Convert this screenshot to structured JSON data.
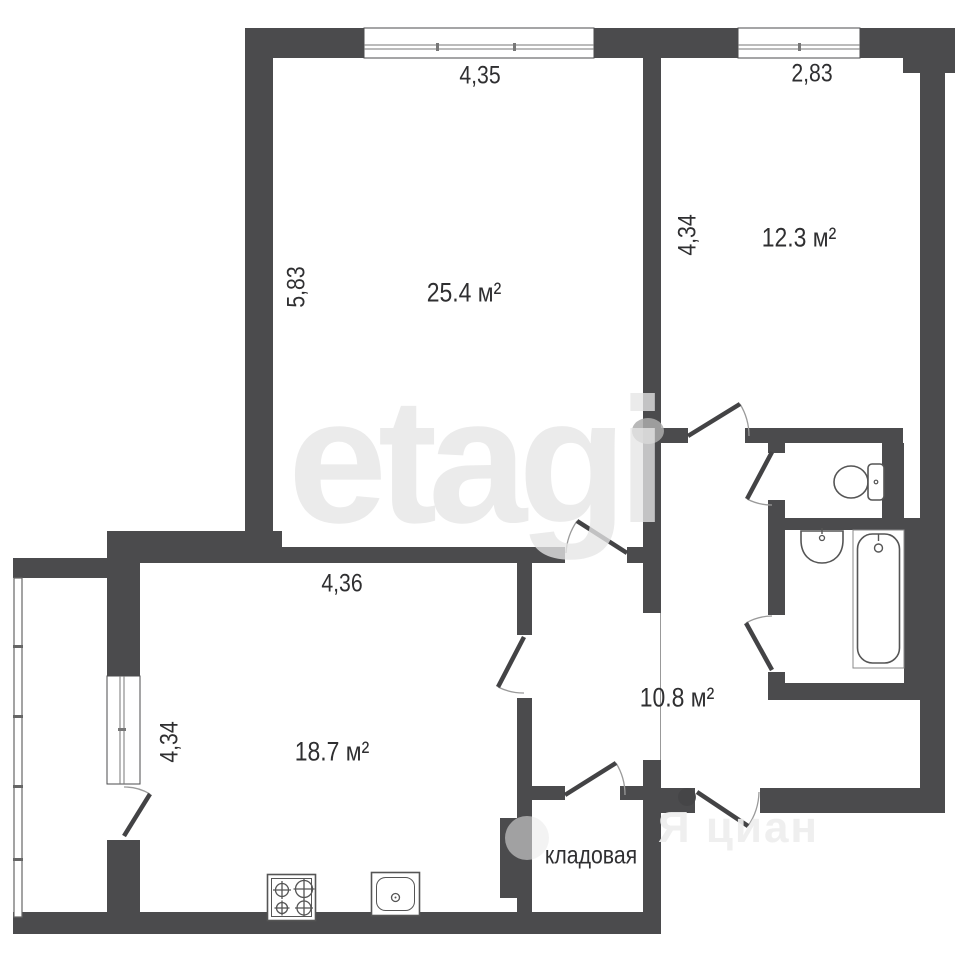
{
  "plan": {
    "title": "apartment-floor-plan",
    "watermark_main": "etagi",
    "watermark_secondary": "Я циан",
    "rooms": {
      "living": {
        "area": "25.4 м²",
        "width_dim": "4,35",
        "height_dim": "5,83"
      },
      "bedroom": {
        "area": "12.3 м²",
        "width_dim": "2,83",
        "height_dim": "4,34"
      },
      "kitchen": {
        "area": "18.7 м²",
        "width_dim": "4,36",
        "height_dim": "4,34"
      },
      "hallway": {
        "area": "10.8 м²"
      },
      "storage": {
        "name": "кладовая"
      }
    },
    "colors": {
      "wall": "#4b4b4d",
      "fixture_line": "#555555",
      "label_text": "#2f2f31",
      "door_leaf": "#434345",
      "door_arc": "#9a9a9a",
      "watermark": "#e9e9e9"
    }
  }
}
